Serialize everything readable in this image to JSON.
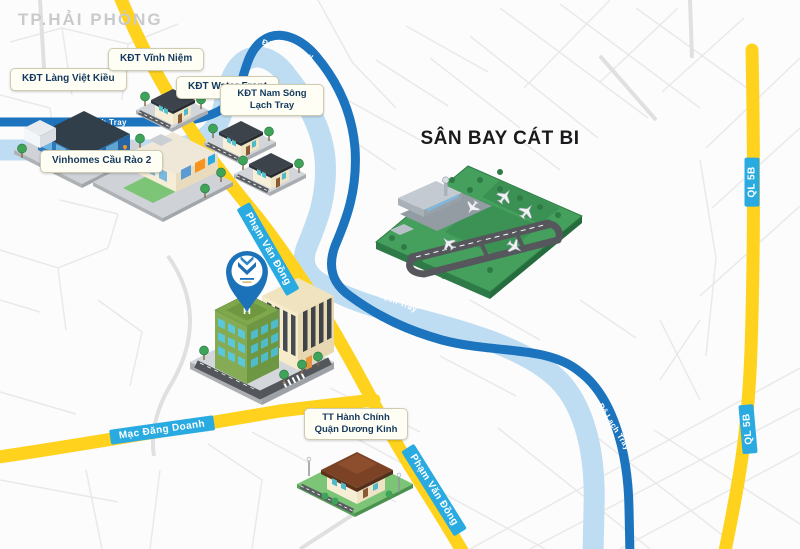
{
  "map": {
    "city_label": "TP.HẢI PHÒNG",
    "airport": {
      "title": "SÂN BAY CÁT BI"
    },
    "locations": {
      "lang_viet_kieu": "KĐT Làng Việt Kiều",
      "vinh_niem": "KĐT Vĩnh Niệm",
      "water_front": "KĐT Water Front",
      "nam_song_line1": "KĐT Nam Sông",
      "nam_song_line2": "Lạch Tray",
      "vinhomes": "Vinhomes Cầu Rào 2",
      "tt_hanh_chinh_line1": "TT Hành Chính",
      "tt_hanh_chinh_line2": "Quận Dương Kinh"
    },
    "roads": {
      "pham_van_dong": "Phạm Văn Đồng",
      "mac_dang_doanh": "Mạc Đăng Doanh",
      "ql_5b": "QL 5B",
      "de_lach_tray": "Đê Lạch Tray"
    },
    "project_marker": {
      "helipad_letter": "H"
    },
    "colors": {
      "road_primary_yellow": "#FFD21E",
      "road_de_lach_tray_blue": "#1C73BE",
      "river_light_blue": "#BFDDF2",
      "road_label_bg": "#29ABE2",
      "location_label_bg": "#FFFEF4",
      "location_label_text": "#14395E",
      "airport_green": "#44A05C",
      "pin_blue": "#1C72B8"
    }
  }
}
